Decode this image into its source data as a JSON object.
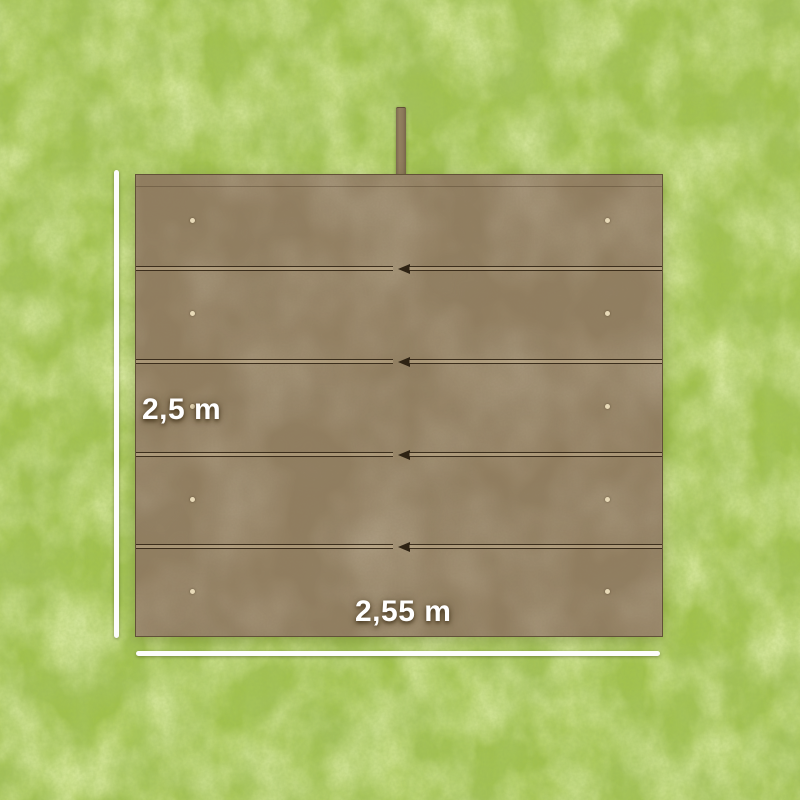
{
  "scene": {
    "description": "Top view of a brown tarpaulin cover laid flat on a green grass lawn, annotated with white dimension lines",
    "dimensions": {
      "height": {
        "label": "2,5 m"
      },
      "width": {
        "label": "2,55 m"
      }
    },
    "tarp": {
      "panel_count": 5,
      "seam_count": 4,
      "seam_arrow_direction": "left",
      "eyelet_rows": 5,
      "eyelet_columns": 2,
      "strap": "top-center-hanging-strap"
    },
    "colors": {
      "grass_base": "#a2c24b",
      "grass_dark": "#6e9a2e",
      "grass_light": "#c6de78",
      "tarp_base": "#917e60",
      "seam_dark": "#2e2314",
      "eyelet": "#e8dab8",
      "dimension_line": "#ffffff",
      "label_text": "#ffffff"
    }
  }
}
